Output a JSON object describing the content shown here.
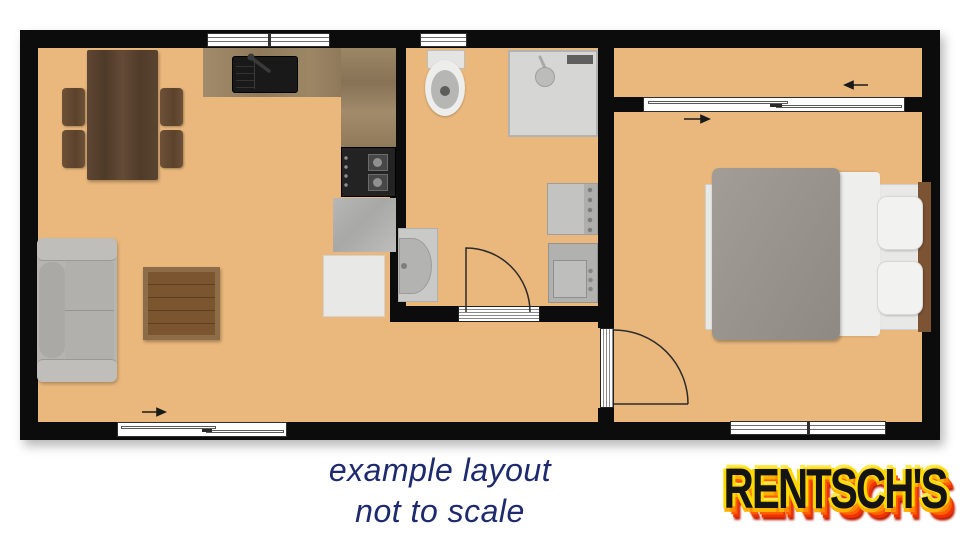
{
  "caption": {
    "line1": "example layout",
    "line2": "not to scale"
  },
  "logo": {
    "text": "RENTSCH'S"
  },
  "colors": {
    "floor": "#eab87c",
    "wall": "#0c0c0c",
    "caption_text": "#1e2a6e",
    "logo_face": "#141414",
    "logo_fire_yellow": "#ffd900",
    "logo_fire_orange": "#ff8a00",
    "logo_fire_red": "#ee3300"
  }
}
